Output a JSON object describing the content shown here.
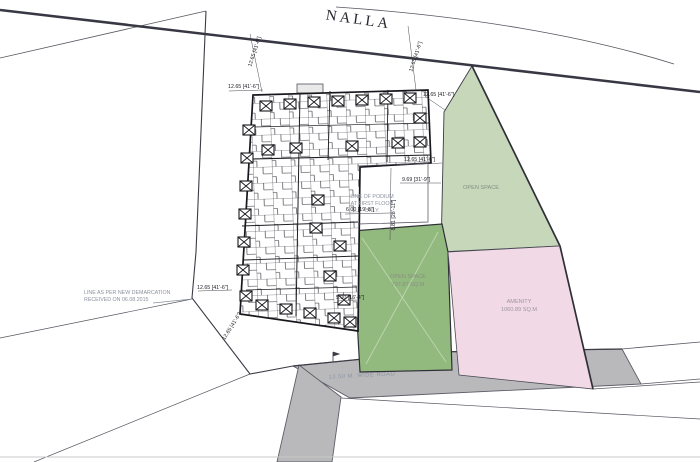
{
  "title": {
    "nalla": "NALLA"
  },
  "areas": {
    "open_space_right": {
      "label": "OPEN SPACE"
    },
    "open_space_mid": {
      "label": "OPEN SPACE",
      "area": "797.87 SQ.M"
    },
    "amenity": {
      "label": "AMENITY",
      "area": "1060.89 SQ.M"
    },
    "road": {
      "label": "13.50 M. WIDE ROAD"
    }
  },
  "notes": {
    "demarcation_line1": "LINE AS PER NEW DEMARCATION",
    "demarcation_line2": "RECEIVED ON 06.08.2015",
    "podium_line1": "LINE OF PODIUM",
    "podium_line2": "AT FIRST FLOOR",
    "podium_line3": "ONLY."
  },
  "dimensions": {
    "d_1265": "12.65 [41'-6\"]",
    "d_969": "9.69 [31'-9\"]",
    "d_881": "8.81 [28'-11\"]",
    "d_600": "6.00 [19'-8\"]",
    "d_500": "5.00 [16'-4\"]"
  },
  "colors": {
    "open_space_light": "#c6d7ba",
    "open_space_dark": "#93ba7e",
    "amenity_pink": "#f1d9e6",
    "road_gray": "#b9b9bc",
    "line_dark": "#383844"
  }
}
